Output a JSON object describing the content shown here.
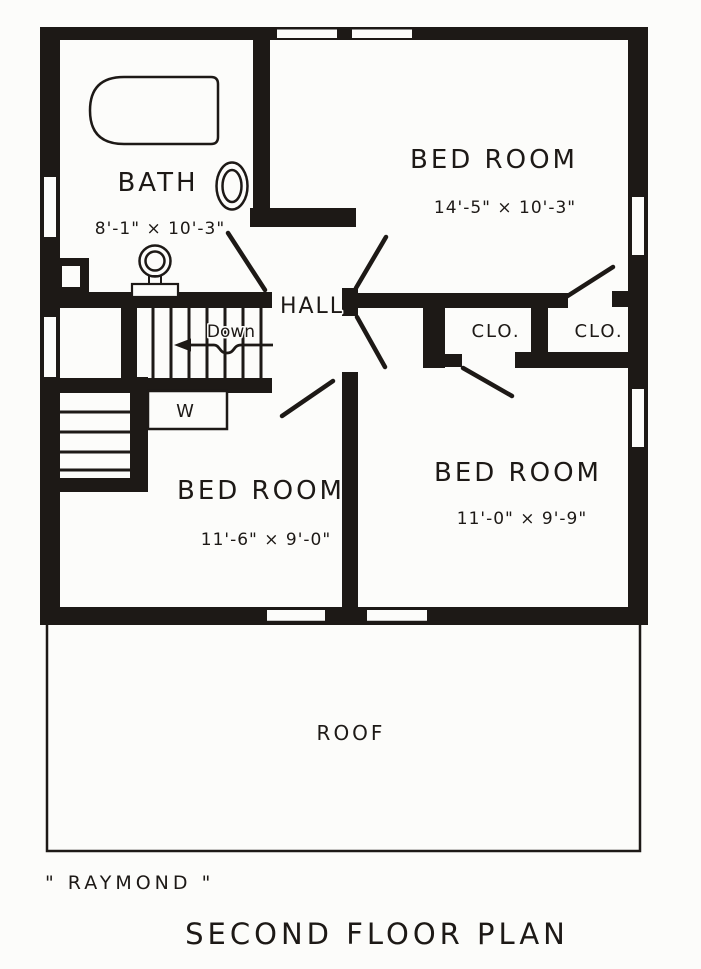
{
  "page": {
    "paper_color": "#fcfcfa",
    "ink_color": "#1d1916",
    "caption": "\" RAYMOND \"",
    "title": "SECOND FLOOR PLAN"
  },
  "plan": {
    "rooms": {
      "bath": {
        "name": "BATH",
        "dims": "8'-1\" × 10'-3\""
      },
      "bedroom_top": {
        "name": "BED ROOM",
        "dims": "14'-5\" × 10'-3\""
      },
      "hall": {
        "name": "HALL"
      },
      "closet_left": {
        "name": "CLO."
      },
      "closet_right": {
        "name": "CLO."
      },
      "bedroom_left": {
        "name": "BED ROOM",
        "dims": "11'-6\" × 9'-0\""
      },
      "bedroom_right": {
        "name": "BED ROOM",
        "dims": "11'-0\" × 9'-9\""
      },
      "roof": {
        "name": "ROOF"
      }
    },
    "stairs": {
      "direction_label": "Down"
    },
    "linen_closet_label": "W"
  }
}
